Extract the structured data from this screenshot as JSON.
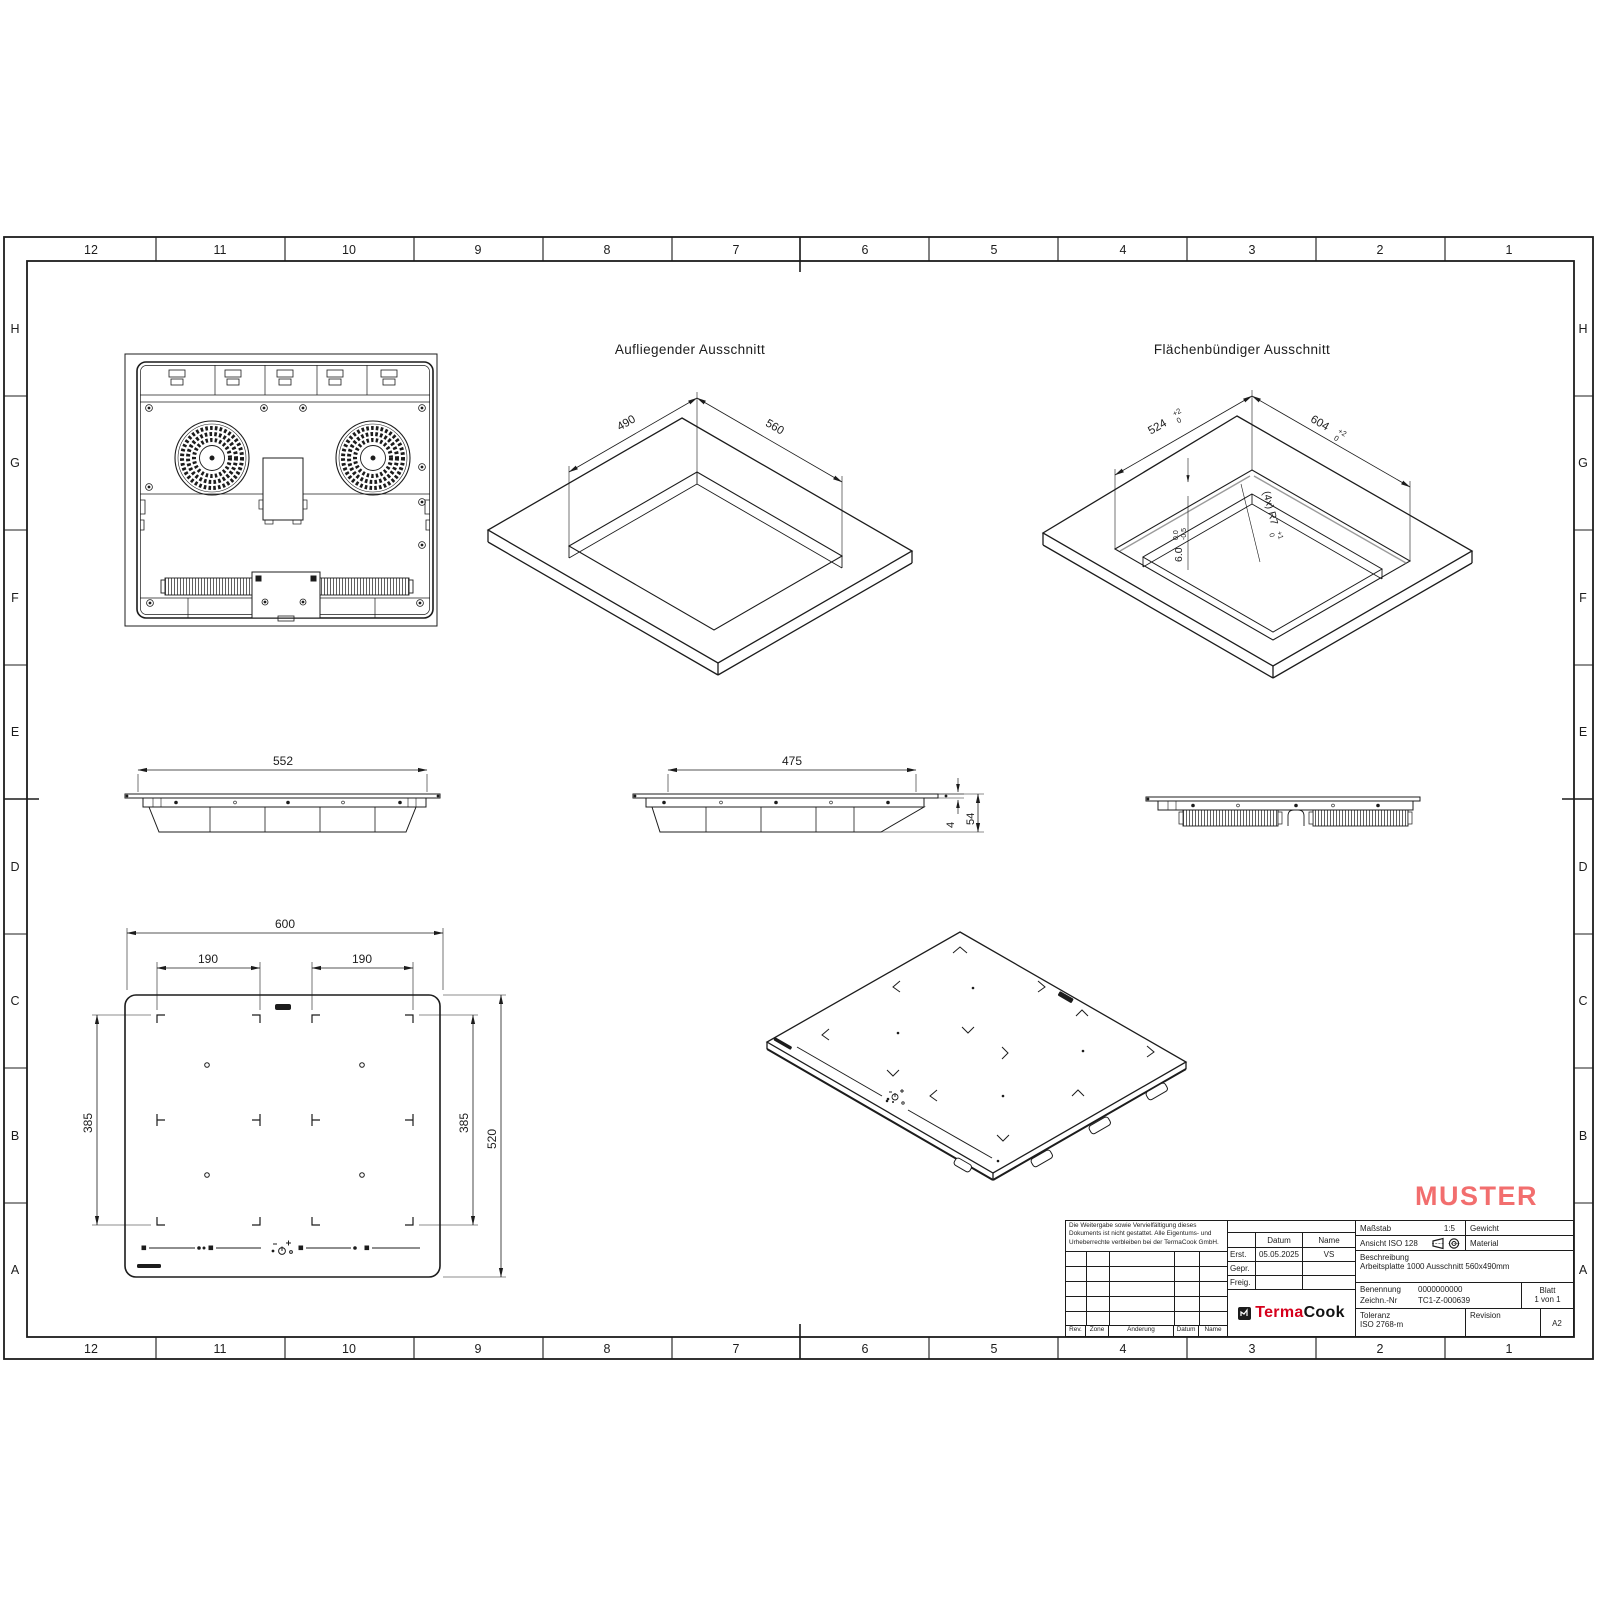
{
  "sheet": {
    "grid_columns": [
      "12",
      "11",
      "10",
      "9",
      "8",
      "7",
      "6",
      "5",
      "4",
      "3",
      "2",
      "1"
    ],
    "grid_rows": [
      "H",
      "G",
      "F",
      "E",
      "D",
      "C",
      "B",
      "A"
    ],
    "watermark": "MUSTER",
    "watermark_color": "#F26E6E",
    "line_color": "#1c1c1c"
  },
  "views": {
    "surface_cutout": {
      "title": "Aufliegender Ausschnitt",
      "dim_width": "490",
      "dim_length": "560"
    },
    "flush_cutout": {
      "title": "Flächenbündiger Ausschnitt",
      "dim_width": "524",
      "dim_width_tol_up": "+2",
      "dim_width_tol_down": "0",
      "dim_length": "604",
      "dim_length_tol_up": "+2",
      "dim_length_tol_down": "0",
      "radius_note": "(4x) R7",
      "radius_tol_up": "+1",
      "radius_tol_down": "0",
      "depth": "6.0",
      "depth_tol_up": "0.0",
      "depth_tol_down": "-0.5"
    },
    "side_left": {
      "dim_width": "552"
    },
    "side_center": {
      "dim_width": "475",
      "dim_glass": "4",
      "dim_height": "54"
    },
    "top_view": {
      "dim_width": "600",
      "dim_zone_left": "190",
      "dim_zone_right": "190",
      "dim_span_left": "385",
      "dim_span_right": "385",
      "dim_depth": "520"
    }
  },
  "title_block": {
    "note": "Die Weitergabe sowie Vervielfältigung dieses Dokuments ist nicht gestattet. Alle Eigentums- und Urheberrechte verbleiben bei der TermaCook GmbH.",
    "rev_table": {
      "rev": "Rev.",
      "zone": "Zone",
      "aenderung": "Änderung",
      "datum": "Datum",
      "name": "Name"
    },
    "approval": {
      "datum_header": "Datum",
      "name_header": "Name",
      "erst_label": "Erst.",
      "erst_datum": "05.05.2025",
      "erst_name": "VS",
      "gepr_label": "Gepr.",
      "freig_label": "Freig."
    },
    "logo": {
      "part1": "Terma",
      "part2": "Cook",
      "red": "#D6001C"
    },
    "masstab_label": "Maßstab",
    "masstab_value": "1:5",
    "gewicht_label": "Gewicht",
    "ansicht_label": "Ansicht ISO 128",
    "material_label": "Material",
    "beschreibung_label": "Beschreibung",
    "beschreibung_value": "Arbeitsplatte 1000 Ausschnitt 560x490mm",
    "benennung_label": "Benennung",
    "benennung_value": "0000000000",
    "zeichn_label": "Zeichn.-Nr",
    "zeichn_value": "TC1-Z-000639",
    "blatt_label": "Blatt",
    "blatt_value": "1 von 1",
    "toleranz_label": "Toleranz",
    "toleranz_value": "ISO 2768-m",
    "revision_label": "Revision",
    "revision_value": "A2"
  }
}
